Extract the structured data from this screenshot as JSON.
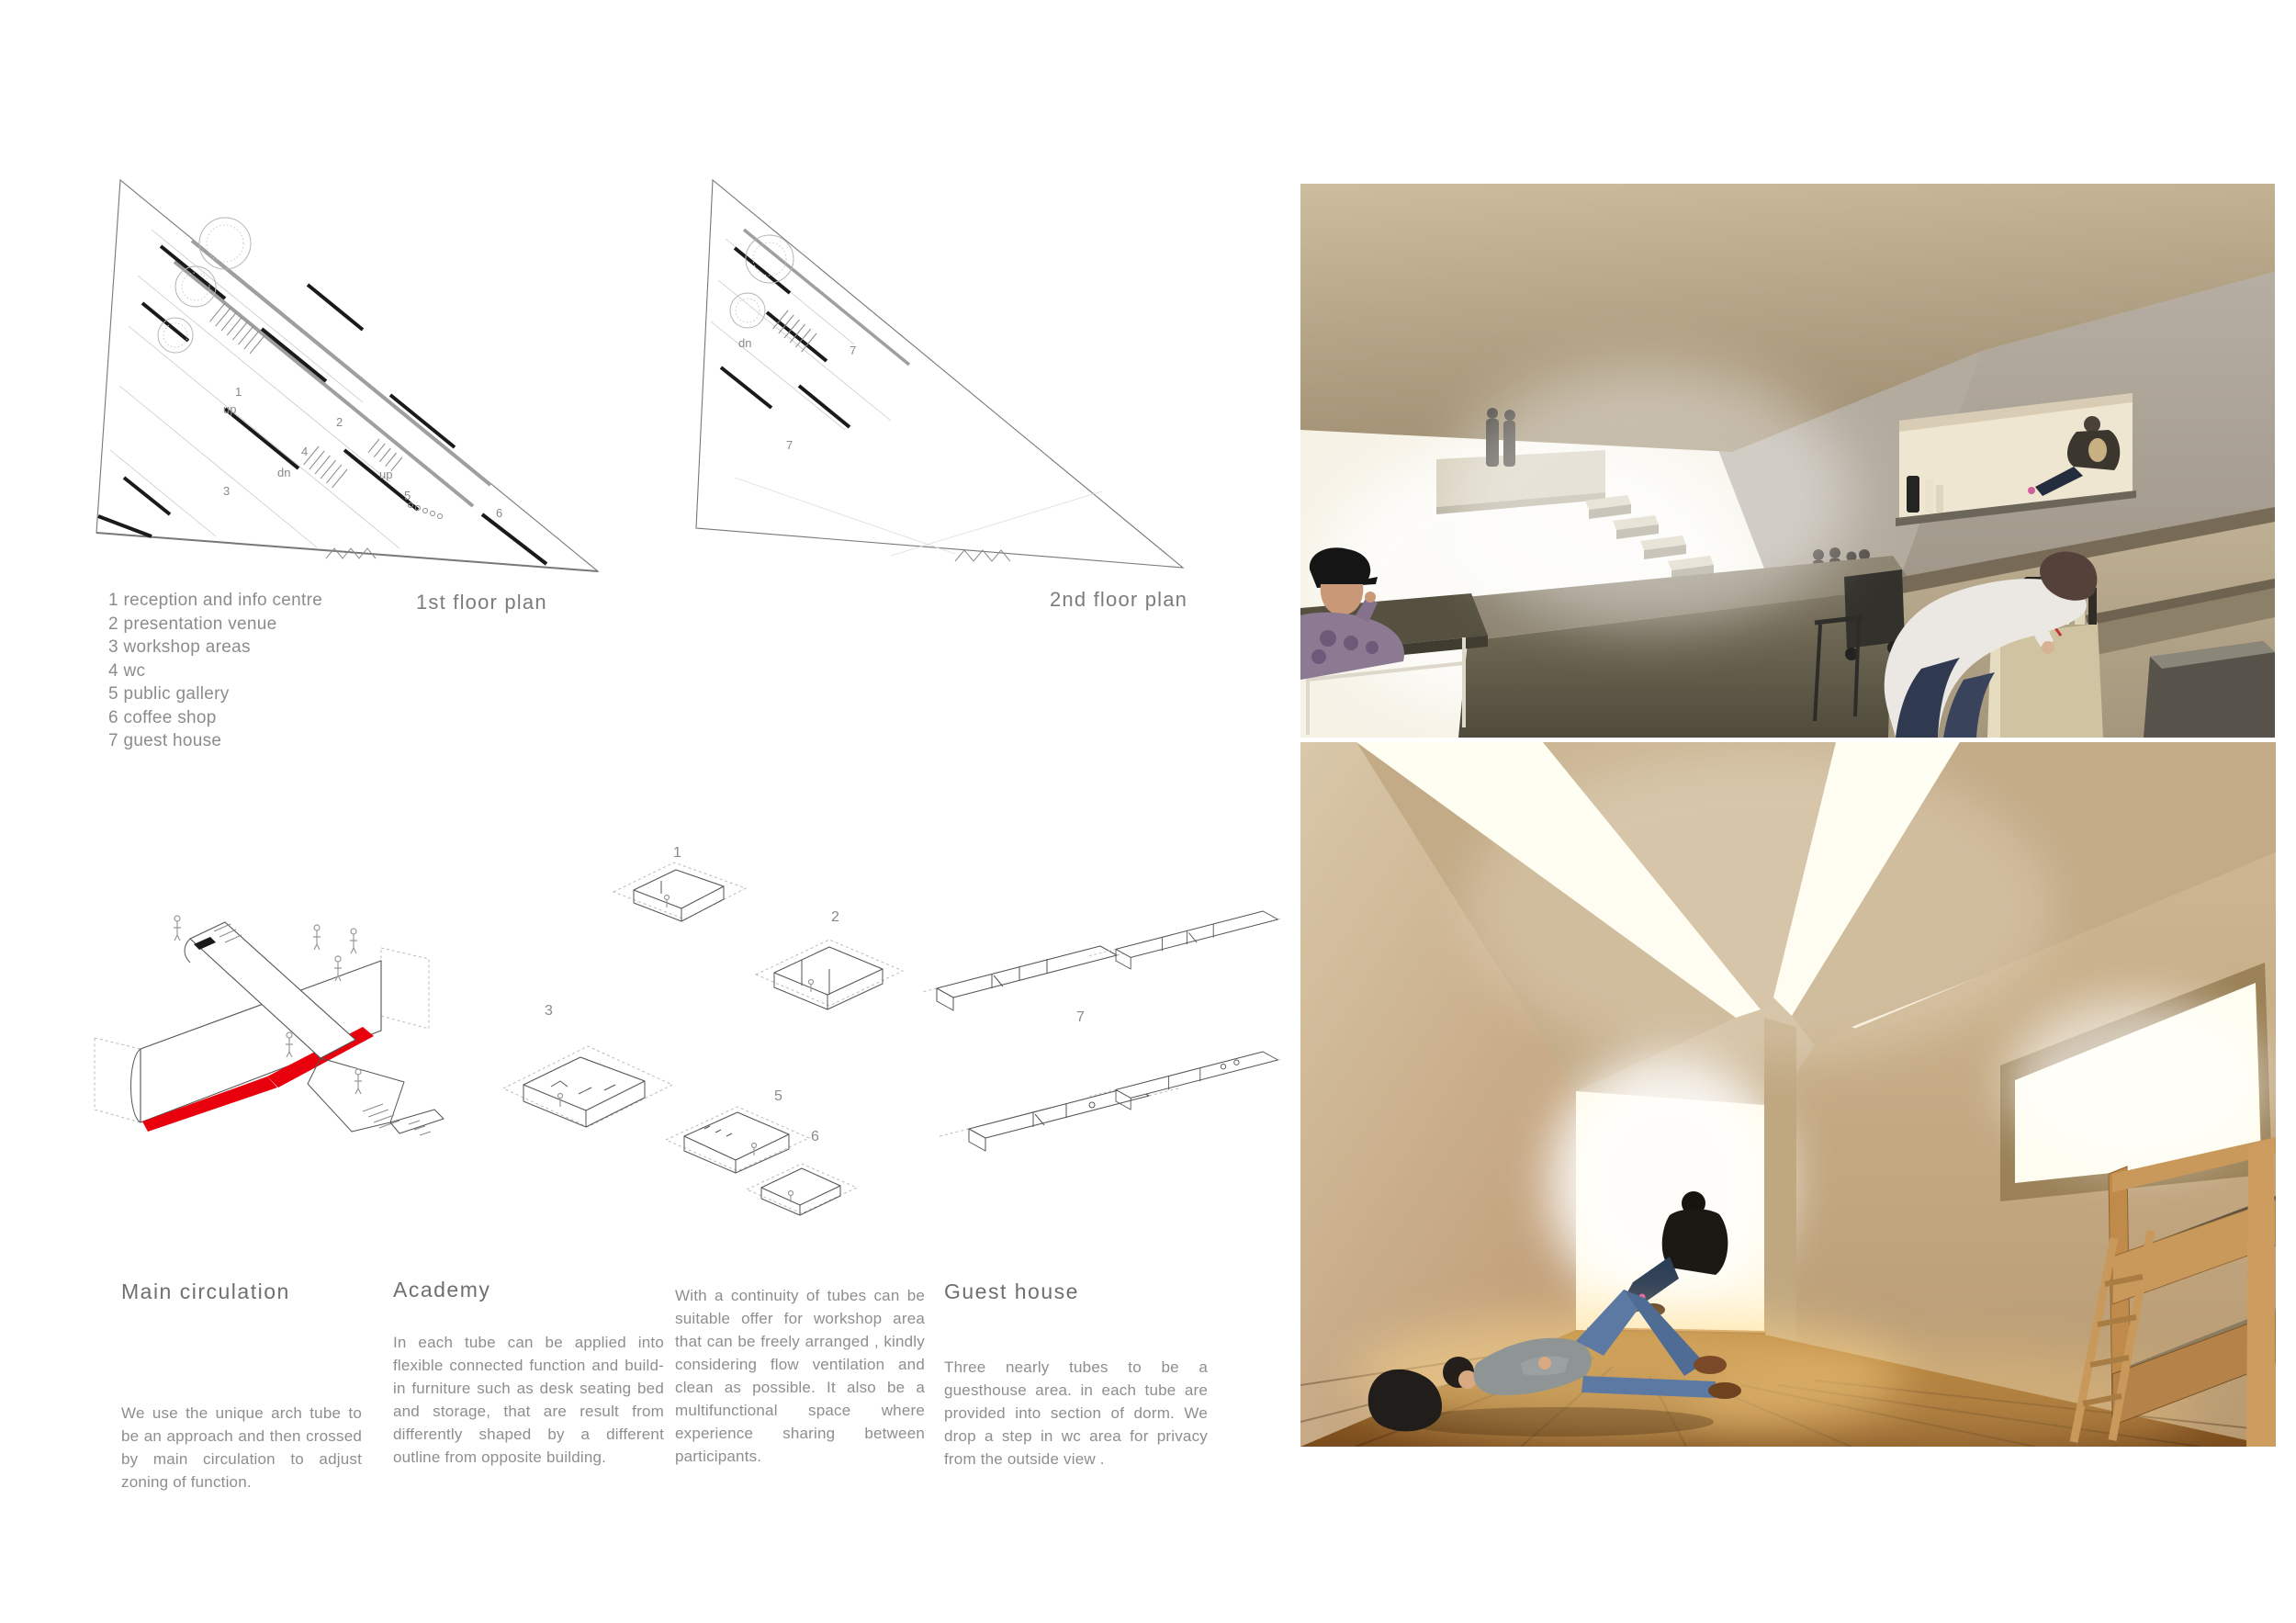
{
  "colors": {
    "accent_red": "#e8000d",
    "text_gray": "#8e8e8e",
    "heading_gray": "#6f6f6f",
    "plan_line_gray": "#777777",
    "render_top_ceiling_tan": "#c3b294",
    "render_top_concrete": "#a49d92",
    "render_top_floor": "#d9d2c2",
    "render_top_platform": "#6f6859",
    "render_bottom_wall_tan": "#c9b693",
    "render_bottom_light": "#fffdf0",
    "render_bottom_wood_floor": "#a9752f",
    "render_bottom_bed_wood": "#c9995c",
    "render_bottom_jeans_blue": "#5b79a2"
  },
  "plans": {
    "first": {
      "title": "1st floor plan",
      "annotations": [
        "1",
        "up",
        "2",
        "dn",
        "up",
        "3",
        "4",
        "5",
        "6"
      ]
    },
    "second": {
      "title": "2nd floor plan",
      "annotations": [
        "dn",
        "7",
        "7"
      ]
    },
    "legend": [
      "1 reception and info centre",
      "2 presentation venue",
      "3 workshop areas",
      "4 wc",
      "5 public gallery",
      "6 coffee shop",
      "7 guest house"
    ]
  },
  "diagrams": {
    "academy_numbers": [
      "1",
      "2",
      "3",
      "5",
      "6"
    ],
    "guesthouse_number": "7"
  },
  "sections": {
    "main_circulation": {
      "heading": "Main circulation",
      "body": "We use the unique arch tube to be an approach and then crossed by main circulation to adjust zoning of function."
    },
    "academy": {
      "heading": "Academy",
      "body": "In each tube can be applied into flexible connected function and build-in furniture such as desk seating bed and storage, that are result from differently shaped by a different outline from opposite building."
    },
    "workshop": {
      "body": "With a continuity of tubes can be suitable offer for workshop area that can be freely arranged , kindly considering flow ventilation and clean as possible. It also be a multifunctional space where experience sharing between participants."
    },
    "guest_house": {
      "heading": "Guest house",
      "body": "Three nearly tubes to be a guesthouse area. in each tube are provided into section of dorm. We drop a step in wc area for privacy from the outside view ."
    }
  }
}
